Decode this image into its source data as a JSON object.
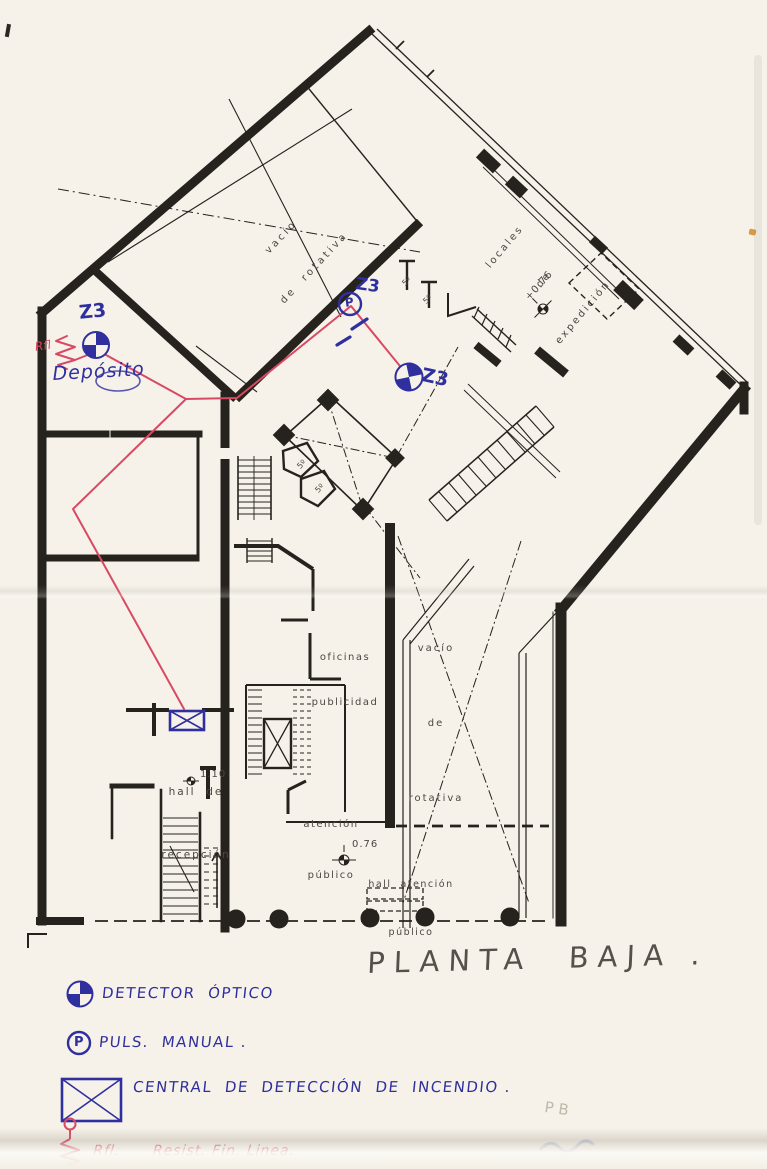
{
  "title": "PLANTA  BAJA .",
  "colors": {
    "ink_blue": "#2f2f9e",
    "ink_red": "#d84a63",
    "line_black": "#26221d",
    "paper": "#f6f2ea"
  },
  "plan_labels": {
    "vacio_rotativa_upper": {
      "l1": "vacío",
      "l2": "de  rotativa"
    },
    "locales_expedicion": {
      "l1": "locales",
      "l2": "de",
      "l3": "expedición"
    },
    "vacio_rotativa_right": {
      "l1": "vacío",
      "l2": "de",
      "l3": "rotativa"
    },
    "oficinas_publicidad": {
      "l1": "oficinas",
      "l2": "publicidad"
    },
    "atencion_publico": {
      "l1": "atención",
      "l2": "público"
    },
    "hall_atencion_publico": {
      "l1": "hall  atención",
      "l2": "público"
    },
    "hall_recepcion": {
      "l1": "hall  de",
      "l2": "recepción"
    },
    "level_recepcion": "1.10",
    "level_hall": "0.76",
    "level_expedicion": "+0.76",
    "room_small": "5º"
  },
  "annotations": {
    "zone": "Z3",
    "deposito": "Depósito",
    "eol_tag": "Rfl",
    "pulsador_letter": "P",
    "faint_mark": "P B"
  },
  "legend": {
    "detector_label": "DETECTOR  ÓPTICO",
    "pulsador_label": "PULS.  MANUAL .",
    "central_label": "CENTRAL  DE  DETECCIÓN  DE  INCENDIO .",
    "resistor_label": "Rfl.      Resist. Fin. Linea.",
    "pulsador_letter": "P",
    "symbols": [
      "optical-detector-icon",
      "manual-call-point-icon",
      "fire-panel-icon",
      "end-of-line-resistor-icon"
    ]
  }
}
